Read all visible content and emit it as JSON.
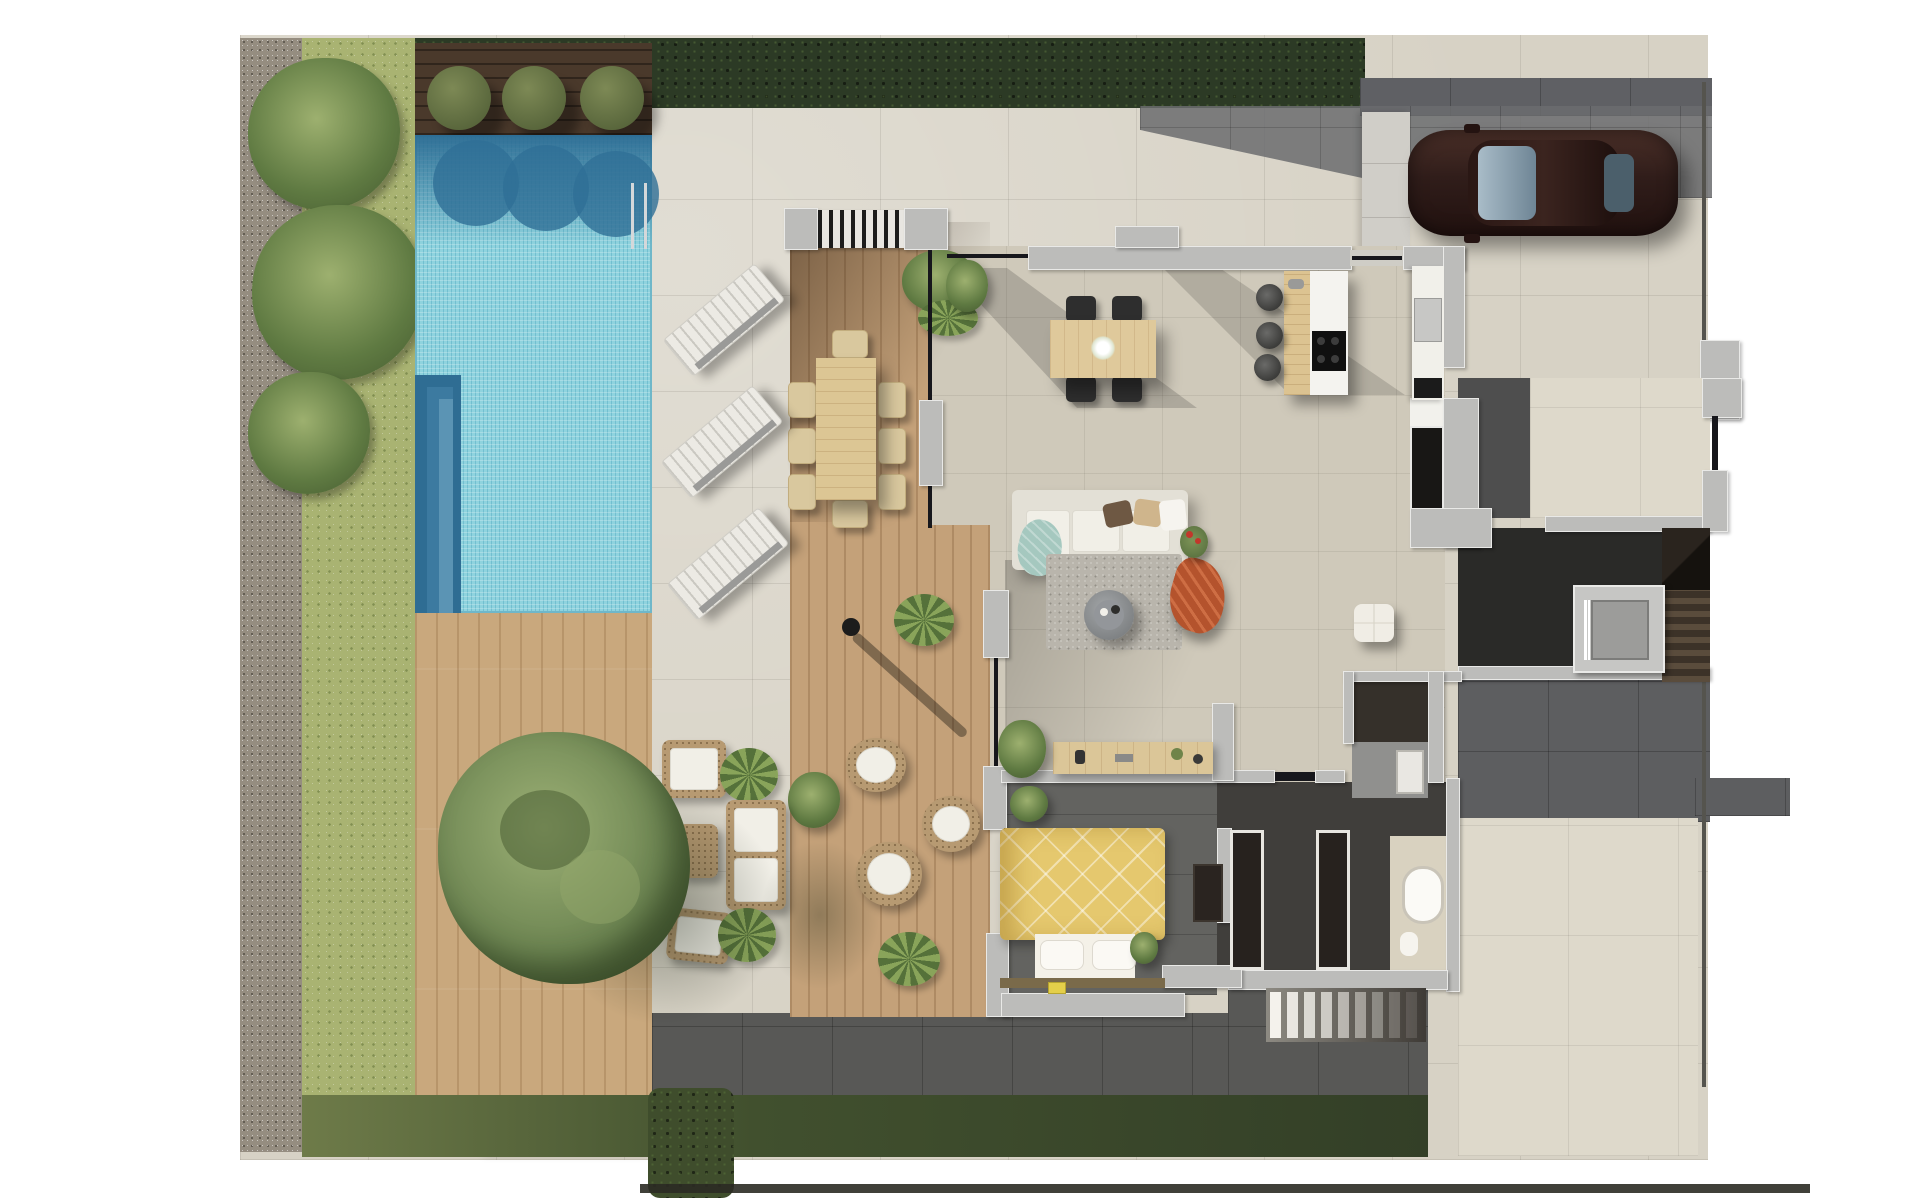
{
  "scene": {
    "label": "Villa ground-floor plan – photorealistic top-down 3D render",
    "type": "architectural-floorplan-render",
    "visible_text": "none"
  },
  "palette": {
    "background": "#ffffff",
    "stone_paving": "#d7d2c5",
    "stone_paving_light": "#ded9cb",
    "dark_paving": "#585856",
    "gravel_border": "#958d80",
    "lawn": "#a9b372",
    "lawn_south": "#4a5a33",
    "hedge": "#2c3a25",
    "pool_water": "#8fd3de",
    "pool_shadow": "#2f6f96",
    "deck_wood": "#c9a87d",
    "dark_wood_deck": "#4a392b",
    "terrace_wood": "#c4a179",
    "wall_gray": "#bcbcba",
    "interior_floor": "#cfc9ba",
    "entry_floor_dark": "#4e4e4e",
    "stair_hall_floor": "#2a2a28",
    "bedroom_floor": "#636360",
    "hallway_floor": "#403e3b",
    "bed_duvet_yellow": "#e5c86e",
    "sofa_white": "#efede6",
    "teal_throw": "#a5c8bf",
    "rust_pouf": "#b4532d",
    "car_body_brown": "#32201c",
    "elevator_gray": "#9c9c9a",
    "tree_green": "#6d8552"
  },
  "areas": {
    "gravel_border": {
      "label": "gravel planting border"
    },
    "lawn_west": {
      "label": "west lawn with palm trees"
    },
    "hedge_top": {
      "label": "perimeter hedge"
    },
    "dark_wood_strip": {
      "label": "dark wood strip with 3 topiary bushes"
    },
    "pool": {
      "label": "swimming pool with steps and ladder"
    },
    "sun_deck": {
      "label": "timber sun deck with tree planter"
    },
    "stone_patio": {
      "label": "stone paved pool patio"
    },
    "covered_terrace": {
      "label": "covered timber terrace with louvered pergola"
    },
    "living_area": {
      "label": "open-plan living / dining / kitchen"
    },
    "entry_hall": {
      "label": "entry hall"
    },
    "stair_hall": {
      "label": "stair and elevator hall"
    },
    "bedroom": {
      "label": "bedroom with double bed"
    },
    "south_hallway": {
      "label": "south hallway with wardrobes"
    },
    "dressing": {
      "label": "dark dressing room"
    },
    "bathroom_north": {
      "label": "shower bathroom"
    },
    "bathroom_se": {
      "label": "en-suite bathroom with tub"
    },
    "driveway": {
      "label": "driveway and parking"
    },
    "walkway": {
      "label": "entrance walkway"
    },
    "rear_patio": {
      "label": "south-east stone patio"
    },
    "lawn_south": {
      "label": "south lawn strip"
    },
    "outdoor_stairs": {
      "label": "outdoor stair to lower level"
    }
  },
  "furniture": {
    "car": {
      "label": "dark brown car",
      "count": 1
    },
    "sun_loungers": {
      "label": "poolside sun loungers",
      "count": 3
    },
    "topiary_bushes": {
      "label": "round topiary bushes",
      "count": 3
    },
    "outdoor_dining": {
      "label": "outdoor dining table with 8 chairs"
    },
    "round_armchairs": {
      "label": "round rattan armchairs",
      "count": 3
    },
    "lounge_set": {
      "label": "rattan lounge set with white cushions"
    },
    "bbq": {
      "label": "outdoor kitchen / bbq counter"
    },
    "tree": {
      "label": "large garden tree"
    },
    "indoor_dining": {
      "label": "dining table with 4 black chairs"
    },
    "kitchen_island": {
      "label": "kitchen island with hob"
    },
    "bar_stools": {
      "label": "bar stools",
      "count": 3
    },
    "sofa": {
      "label": "white sofa with chaise"
    },
    "rug": {
      "label": "gray area rug"
    },
    "coffee_table": {
      "label": "round coffee table"
    },
    "rust_throw": {
      "label": "rust floor pouf"
    },
    "white_pouf": {
      "label": "white tufted pouf"
    },
    "console": {
      "label": "wooden console sideboard"
    },
    "bed": {
      "label": "double bed with yellow duvet"
    },
    "wardrobes": {
      "label": "built-in wardrobes",
      "count": 3
    },
    "bathtub": {
      "label": "oval bathtub"
    },
    "elevator": {
      "label": "elevator"
    },
    "staircase": {
      "label": "interior staircase"
    }
  }
}
